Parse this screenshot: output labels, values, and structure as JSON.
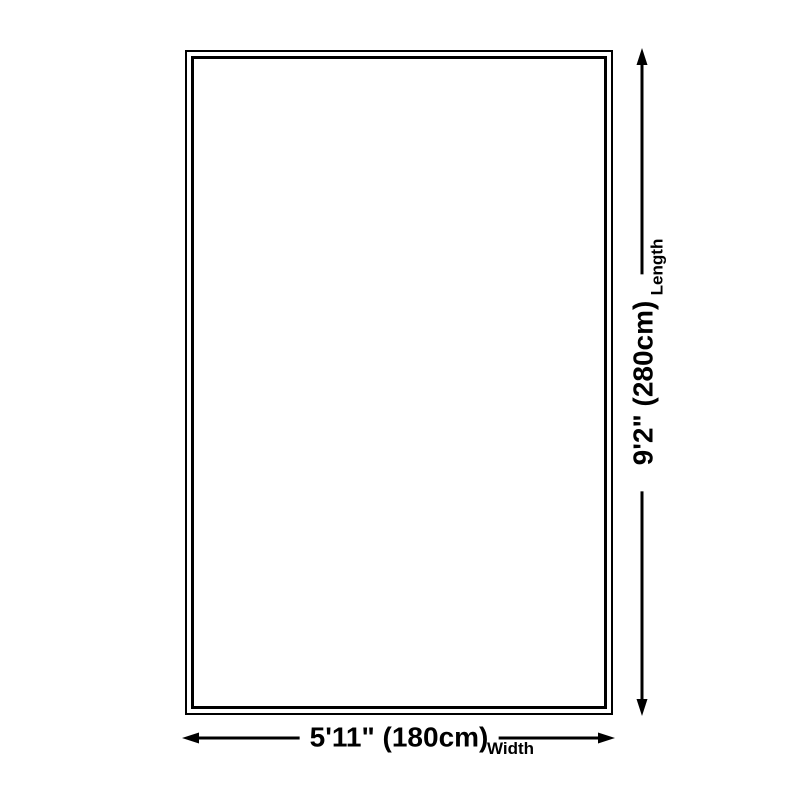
{
  "diagram": {
    "type": "product-size-diagram",
    "background_color": "#ffffff",
    "line_color": "#000000",
    "shape": "rectangle",
    "length": {
      "value": "9'2\" (280cm)",
      "label": "Length"
    },
    "width": {
      "value": "5'11\" (180cm)",
      "label": "Width"
    }
  }
}
